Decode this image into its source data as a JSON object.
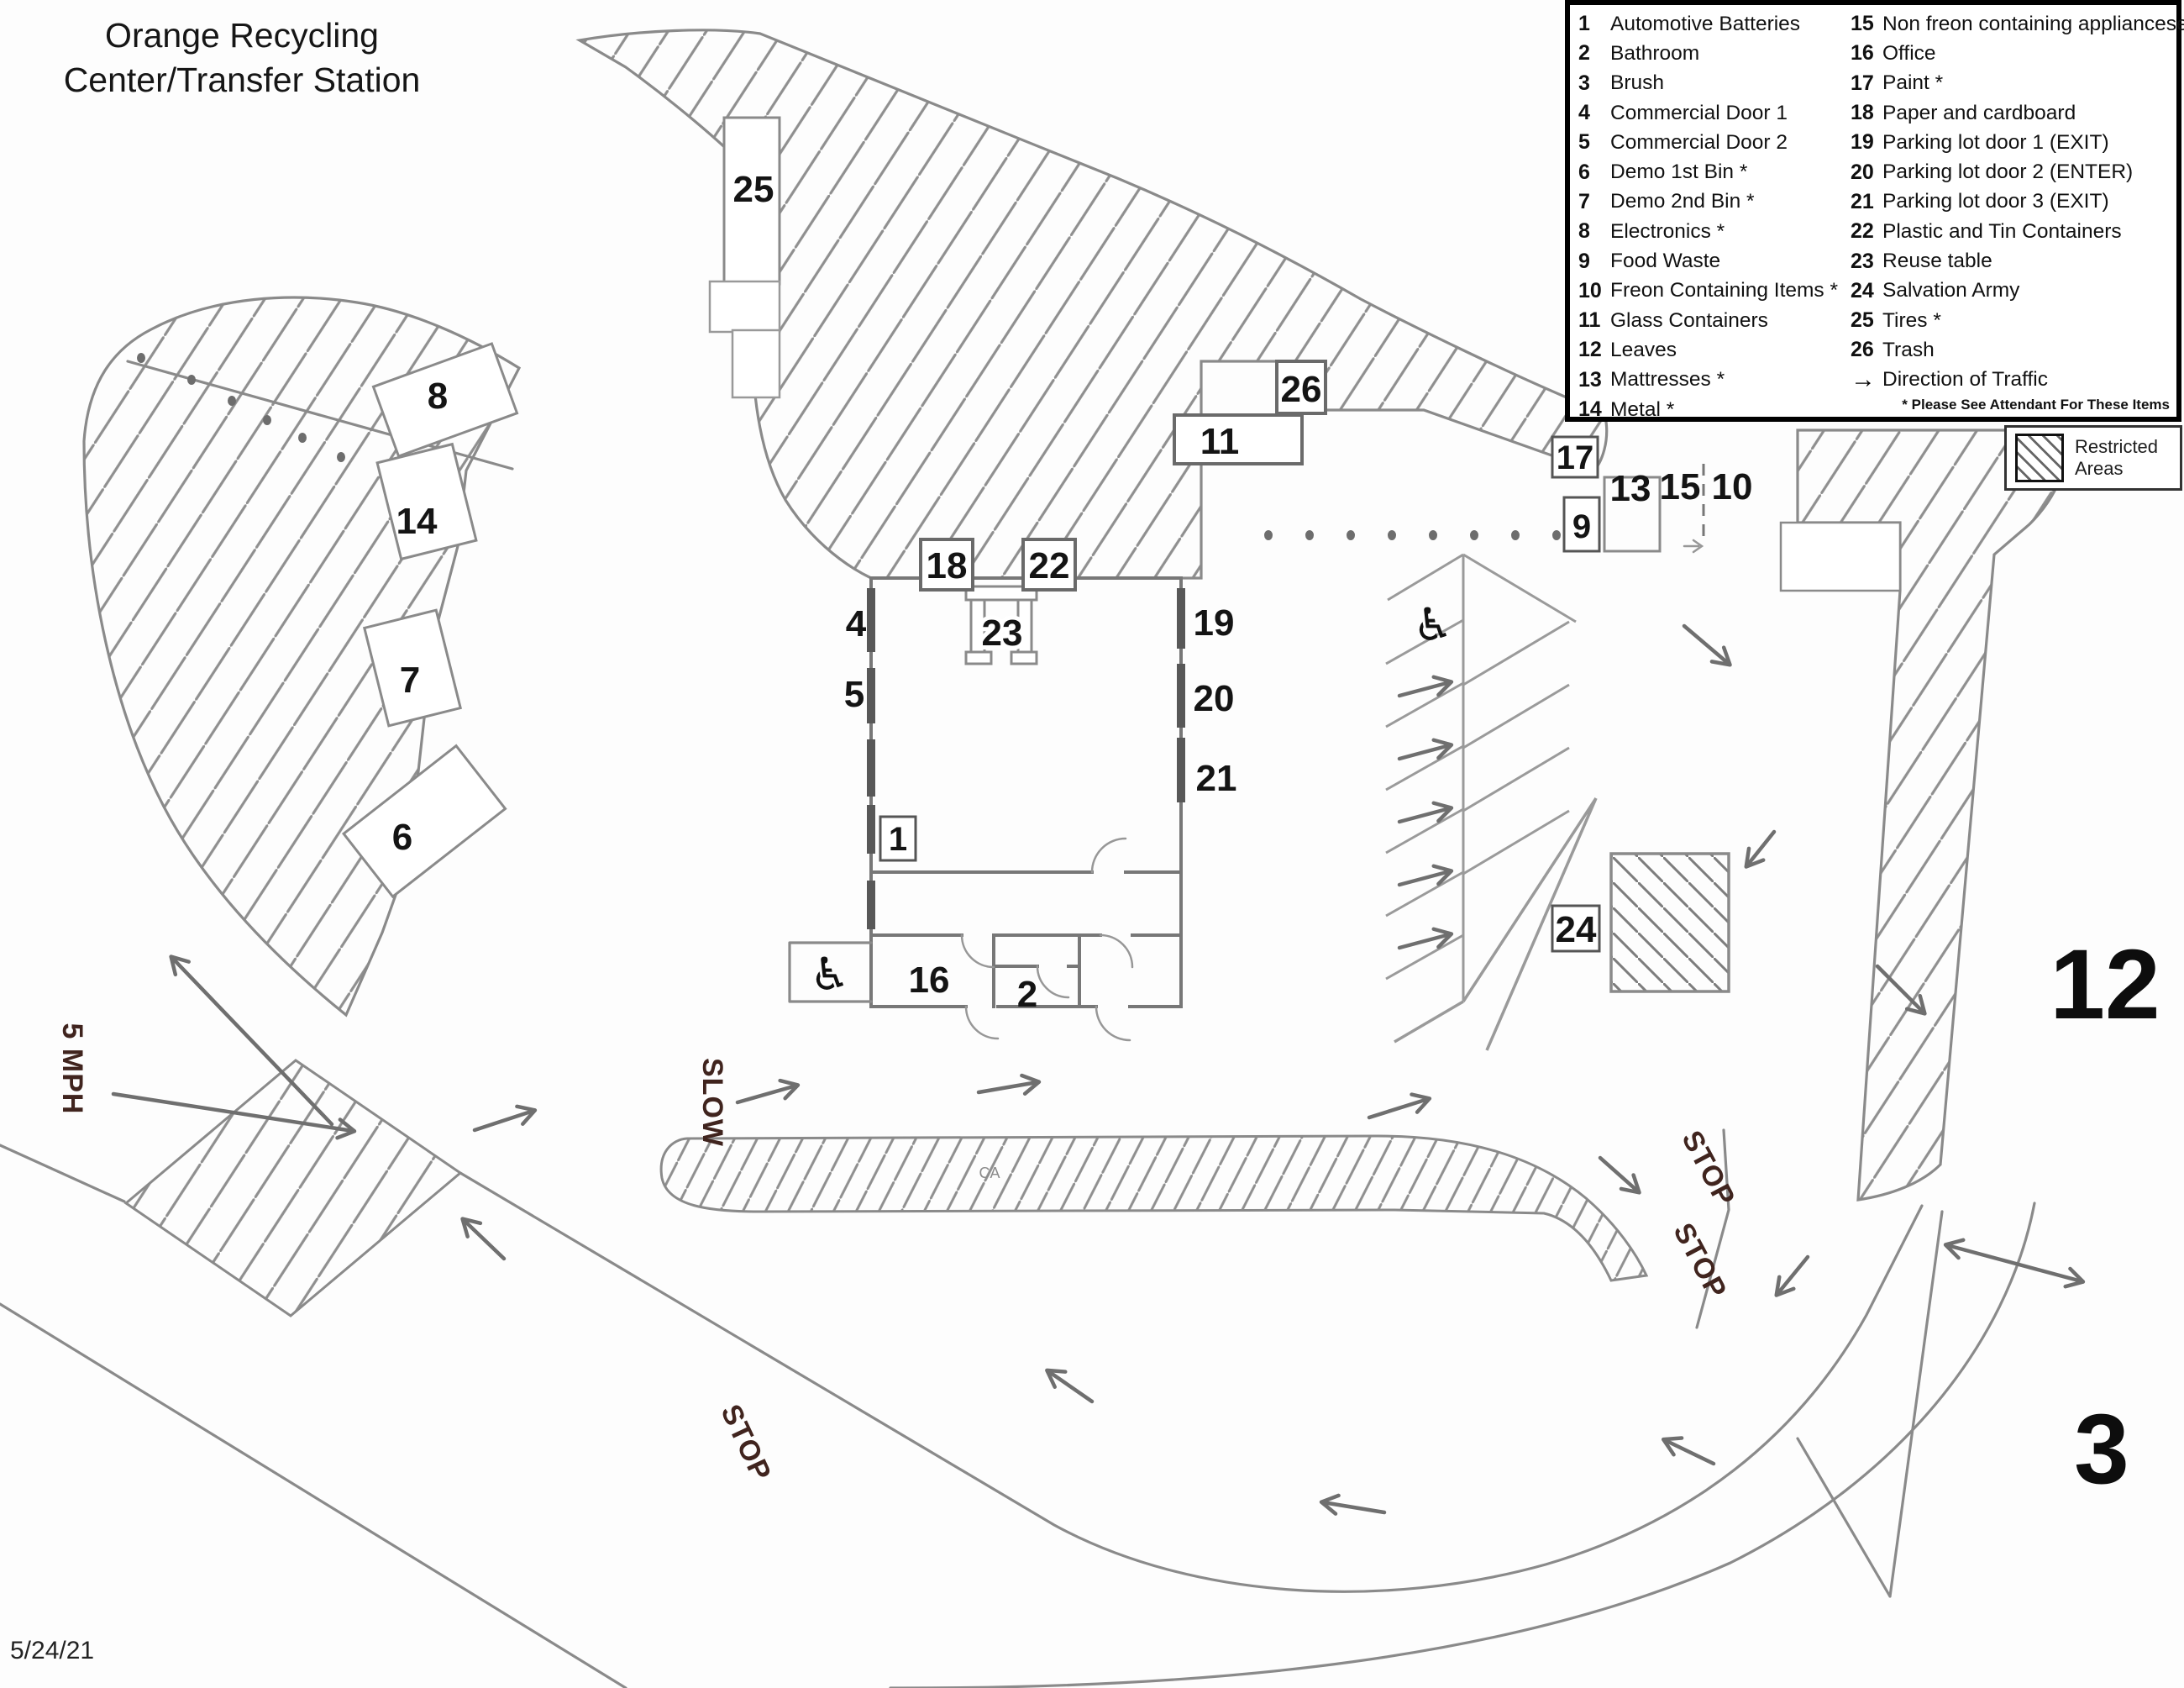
{
  "title": {
    "line1": "Orange Recycling",
    "line2": "Center/Transfer Station"
  },
  "date": "5/24/21",
  "legend": {
    "col1": [
      {
        "num": "1",
        "label": "Automotive Batteries"
      },
      {
        "num": "2",
        "label": "Bathroom"
      },
      {
        "num": "3",
        "label": "Brush"
      },
      {
        "num": "4",
        "label": "Commercial Door 1"
      },
      {
        "num": "5",
        "label": "Commercial Door 2"
      },
      {
        "num": "6",
        "label": "Demo 1st Bin *"
      },
      {
        "num": "7",
        "label": "Demo 2nd Bin *"
      },
      {
        "num": "8",
        "label": "Electronics *"
      },
      {
        "num": "9",
        "label": "Food Waste"
      },
      {
        "num": "10",
        "label": "Freon Containing Items *"
      },
      {
        "num": "11",
        "label": "Glass Containers"
      },
      {
        "num": "12",
        "label": "Leaves"
      },
      {
        "num": "13",
        "label": "Mattresses *"
      },
      {
        "num": "14",
        "label": "Metal *"
      }
    ],
    "col2": [
      {
        "num": "15",
        "label": "Non freon containing appliancese *"
      },
      {
        "num": "16",
        "label": "Office"
      },
      {
        "num": "17",
        "label": "Paint *"
      },
      {
        "num": "18",
        "label": "Paper and cardboard"
      },
      {
        "num": "19",
        "label": "Parking lot door 1 (EXIT)"
      },
      {
        "num": "20",
        "label": "Parking lot door 2 (ENTER)"
      },
      {
        "num": "21",
        "label": "Parking lot door 3 (EXIT)"
      },
      {
        "num": "22",
        "label": "Plastic and Tin Containers"
      },
      {
        "num": "23",
        "label": "Reuse table"
      },
      {
        "num": "24",
        "label": "Salvation Army"
      },
      {
        "num": "25",
        "label": "Tires *"
      },
      {
        "num": "26",
        "label": "Trash"
      }
    ],
    "direction": {
      "arrow": "→",
      "label": "Direction of Traffic"
    },
    "footnote": "* Please See Attendant For These Items"
  },
  "restricted_key": {
    "label": "Restricted Areas"
  },
  "map_labels": {
    "n1": "1",
    "n2": "2",
    "n4": "4",
    "n5": "5",
    "n6": "6",
    "n7": "7",
    "n8": "8",
    "n9": "9",
    "n10": "10",
    "n11": "11",
    "n13": "13",
    "n14": "14",
    "n15": "15",
    "n16": "16",
    "n17": "17",
    "n18": "18",
    "n19": "19",
    "n20": "20",
    "n21": "21",
    "n22": "22",
    "n23": "23",
    "n24": "24",
    "n25": "25",
    "n26": "26",
    "big12": "12",
    "big3": "3"
  },
  "road_markings": {
    "mph": "5 MPH",
    "slow": "SLOW",
    "stop1": "STOP",
    "stop2": "STOP",
    "stop3": "STOP",
    "ca": "CA"
  },
  "icons": {
    "wheelchair": "♿"
  },
  "colors": {
    "pencil": "#8a8a8a",
    "ink": "#141414",
    "road_text": "#40241e"
  }
}
